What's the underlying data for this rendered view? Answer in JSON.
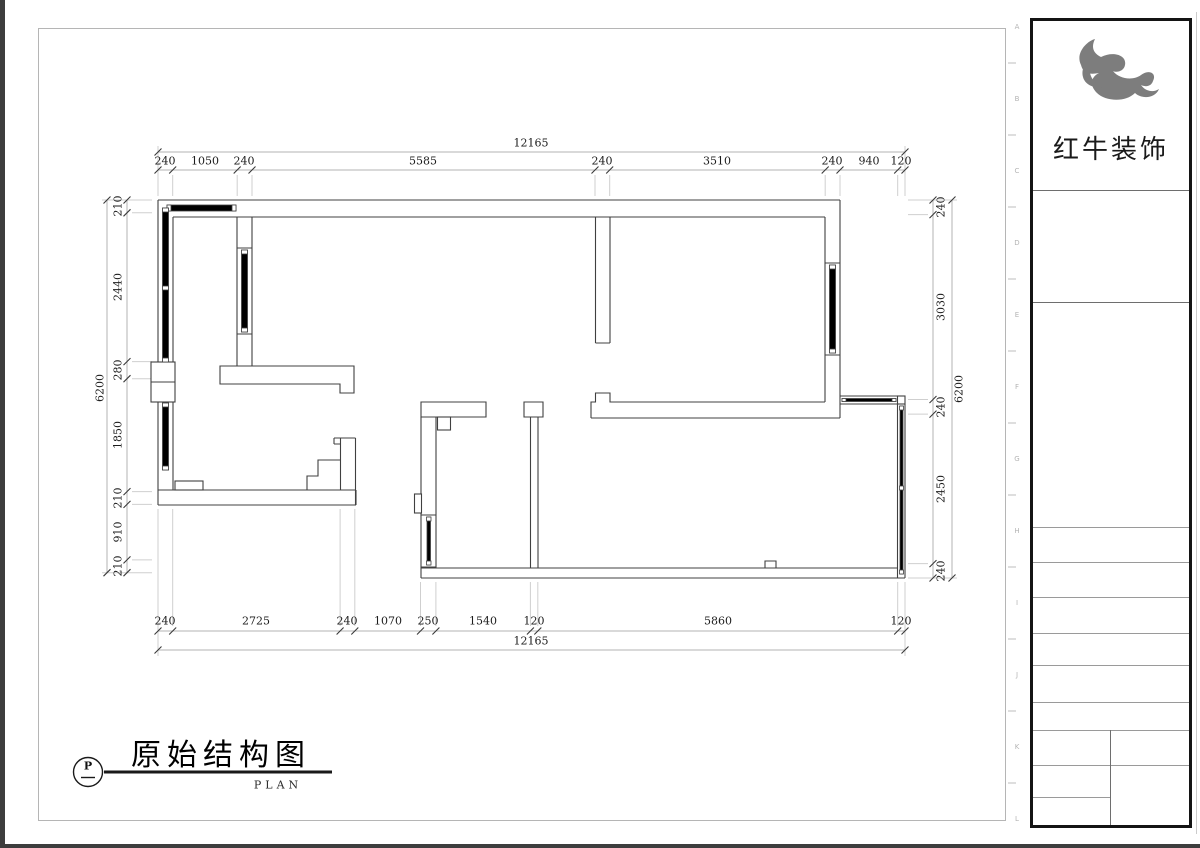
{
  "title_block": {
    "title": "原始结构图",
    "subtitle": "PLAN",
    "marker_letter": "P"
  },
  "brand": {
    "name": "红牛装饰"
  },
  "dimensions": {
    "top": {
      "total": "12165",
      "segments": [
        "240",
        "1050",
        "240",
        "5585",
        "240",
        "3510",
        "240",
        "940",
        "120"
      ]
    },
    "bottom": {
      "total": "12165",
      "segments": [
        "240",
        "2725",
        "240",
        "1070",
        "250",
        "1540",
        "120",
        "5860",
        "120"
      ]
    },
    "left": {
      "total": "6200",
      "segments": [
        "210",
        "2440",
        "280",
        "1850",
        "210",
        "910",
        "210"
      ]
    },
    "right": {
      "total": "6200",
      "segments": [
        "240",
        "3030",
        "240",
        "2450",
        "240"
      ]
    }
  },
  "frame_ruler": {
    "letters": [
      "A",
      "B",
      "C",
      "D",
      "E",
      "F",
      "G",
      "H",
      "I",
      "J",
      "K",
      "L"
    ]
  }
}
